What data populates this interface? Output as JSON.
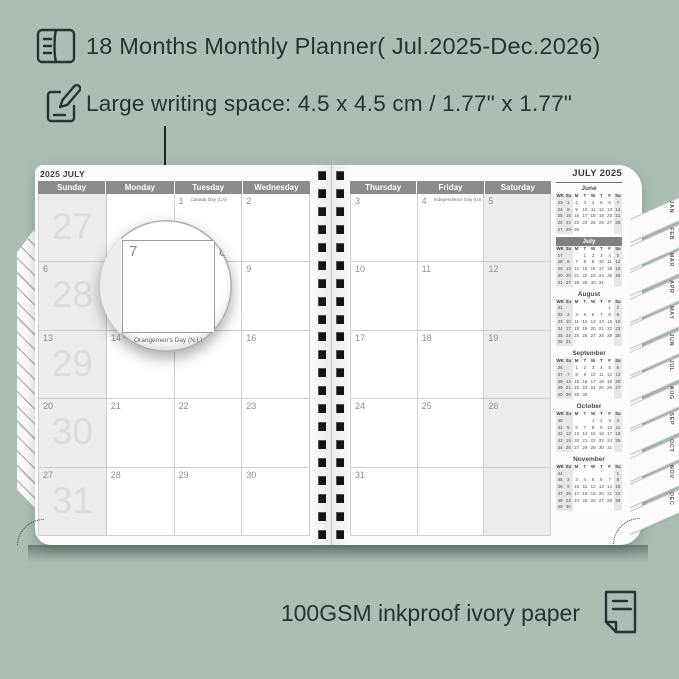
{
  "colors": {
    "background": "#a9bfb4",
    "ink": "#243430",
    "page": "#fcfcfa",
    "header_bar": "#8b8b8a",
    "shade": "#ececea",
    "mini_highlight": "#7f7f7d"
  },
  "annotations": {
    "title": "18 Months Monthly Planner( Jul.2025-Dec.2026)",
    "subtitle": "Large writing space: 4.5 x 4.5 cm / 1.77\" x 1.77\"",
    "footer": "100GSM inkproof ivory paper"
  },
  "planner": {
    "left_page": {
      "page_label": "2025 JULY",
      "day_headers": [
        "Sunday",
        "Monday",
        "Tuesday",
        "Wednesday"
      ],
      "weeks": [
        {
          "week_number": "27",
          "cells": [
            {
              "date": ""
            },
            {
              "date": ""
            },
            {
              "date": "1",
              "event": "Canada Day (CA)"
            },
            {
              "date": "2"
            }
          ]
        },
        {
          "week_number": "28",
          "cells": [
            {
              "date": "6"
            },
            {
              "date": "7"
            },
            {
              "date": "8"
            },
            {
              "date": "9"
            }
          ]
        },
        {
          "week_number": "29",
          "cells": [
            {
              "date": "13"
            },
            {
              "date": "14",
              "event": "Orangemen's Day (N.I.)"
            },
            {
              "date": "15"
            },
            {
              "date": "16"
            }
          ]
        },
        {
          "week_number": "30",
          "cells": [
            {
              "date": "20"
            },
            {
              "date": "21"
            },
            {
              "date": "22"
            },
            {
              "date": "23"
            }
          ]
        },
        {
          "week_number": "31",
          "cells": [
            {
              "date": "27"
            },
            {
              "date": "28"
            },
            {
              "date": "29"
            },
            {
              "date": "30"
            }
          ]
        }
      ]
    },
    "right_page": {
      "page_label": "JULY 2025",
      "day_headers": [
        "Thursday",
        "Friday",
        "Saturday"
      ],
      "weeks": [
        {
          "cells": [
            {
              "date": "3"
            },
            {
              "date": "4",
              "event": "Independence Day (US)"
            },
            {
              "date": "5"
            }
          ]
        },
        {
          "cells": [
            {
              "date": "10"
            },
            {
              "date": "11"
            },
            {
              "date": "12"
            }
          ]
        },
        {
          "cells": [
            {
              "date": "17"
            },
            {
              "date": "18"
            },
            {
              "date": "19"
            }
          ]
        },
        {
          "cells": [
            {
              "date": "24"
            },
            {
              "date": "25"
            },
            {
              "date": "26"
            }
          ]
        },
        {
          "cells": [
            {
              "date": "31"
            },
            {
              "date": ""
            },
            {
              "date": ""
            }
          ]
        }
      ]
    },
    "mini_header": [
      "WK",
      "Su",
      "M",
      "T",
      "W",
      "T",
      "F",
      "Sa"
    ],
    "mini_calendars": [
      {
        "title": "June",
        "highlight": false,
        "rows": [
          [
            "23",
            "1",
            "2",
            "3",
            "4",
            "5",
            "6",
            "7"
          ],
          [
            "24",
            "8",
            "9",
            "10",
            "11",
            "12",
            "13",
            "14"
          ],
          [
            "25",
            "15",
            "16",
            "17",
            "18",
            "19",
            "20",
            "21"
          ],
          [
            "26",
            "22",
            "23",
            "24",
            "25",
            "26",
            "27",
            "28"
          ],
          [
            "27",
            "29",
            "30",
            "",
            "",
            "",
            "",
            ""
          ]
        ]
      },
      {
        "title": "July",
        "highlight": true,
        "rows": [
          [
            "27",
            "",
            "",
            "1",
            "2",
            "3",
            "4",
            "5"
          ],
          [
            "28",
            "6",
            "7",
            "8",
            "9",
            "10",
            "11",
            "12"
          ],
          [
            "29",
            "13",
            "14",
            "15",
            "16",
            "17",
            "18",
            "19"
          ],
          [
            "30",
            "20",
            "21",
            "22",
            "23",
            "24",
            "25",
            "26"
          ],
          [
            "31",
            "27",
            "28",
            "29",
            "30",
            "31",
            "",
            ""
          ]
        ]
      },
      {
        "title": "August",
        "highlight": false,
        "rows": [
          [
            "31",
            "",
            "",
            "",
            "",
            "",
            "1",
            "2"
          ],
          [
            "32",
            "3",
            "4",
            "5",
            "6",
            "7",
            "8",
            "9"
          ],
          [
            "33",
            "10",
            "11",
            "12",
            "13",
            "14",
            "15",
            "16"
          ],
          [
            "34",
            "17",
            "18",
            "19",
            "20",
            "21",
            "22",
            "23"
          ],
          [
            "35",
            "24",
            "25",
            "26",
            "27",
            "28",
            "29",
            "30"
          ],
          [
            "36",
            "31",
            "",
            "",
            "",
            "",
            "",
            ""
          ]
        ]
      },
      {
        "title": "September",
        "highlight": false,
        "rows": [
          [
            "36",
            "",
            "1",
            "2",
            "3",
            "4",
            "5",
            "6"
          ],
          [
            "37",
            "7",
            "8",
            "9",
            "10",
            "11",
            "12",
            "13"
          ],
          [
            "38",
            "14",
            "15",
            "16",
            "17",
            "18",
            "19",
            "20"
          ],
          [
            "39",
            "21",
            "22",
            "23",
            "24",
            "25",
            "26",
            "27"
          ],
          [
            "40",
            "28",
            "29",
            "30",
            "",
            "",
            "",
            ""
          ]
        ]
      },
      {
        "title": "October",
        "highlight": false,
        "rows": [
          [
            "40",
            "",
            "",
            "",
            "1",
            "2",
            "3",
            "4"
          ],
          [
            "41",
            "5",
            "6",
            "7",
            "8",
            "9",
            "10",
            "11"
          ],
          [
            "42",
            "12",
            "13",
            "14",
            "15",
            "16",
            "17",
            "18"
          ],
          [
            "43",
            "19",
            "20",
            "21",
            "22",
            "23",
            "24",
            "25"
          ],
          [
            "44",
            "26",
            "27",
            "28",
            "29",
            "30",
            "31",
            ""
          ]
        ]
      },
      {
        "title": "November",
        "highlight": false,
        "rows": [
          [
            "44",
            "",
            "",
            "",
            "",
            "",
            "",
            "1"
          ],
          [
            "45",
            "2",
            "3",
            "4",
            "5",
            "6",
            "7",
            "8"
          ],
          [
            "46",
            "9",
            "10",
            "11",
            "12",
            "13",
            "14",
            "15"
          ],
          [
            "47",
            "16",
            "17",
            "18",
            "19",
            "20",
            "21",
            "22"
          ],
          [
            "48",
            "23",
            "24",
            "25",
            "26",
            "27",
            "28",
            "29"
          ],
          [
            "49",
            "30",
            "",
            "",
            "",
            "",
            "",
            ""
          ]
        ]
      }
    ],
    "tabs": [
      "JAN",
      "FEB",
      "MAR",
      "APR",
      "MAY",
      "JUN",
      "JUL",
      "AUG",
      "SEP",
      "OCT",
      "NOV",
      "DEC"
    ],
    "magnifier": {
      "date": "7",
      "adjacent_date": "8",
      "below_date": "14",
      "event": "Orangemen's Day (N.I.)"
    }
  }
}
